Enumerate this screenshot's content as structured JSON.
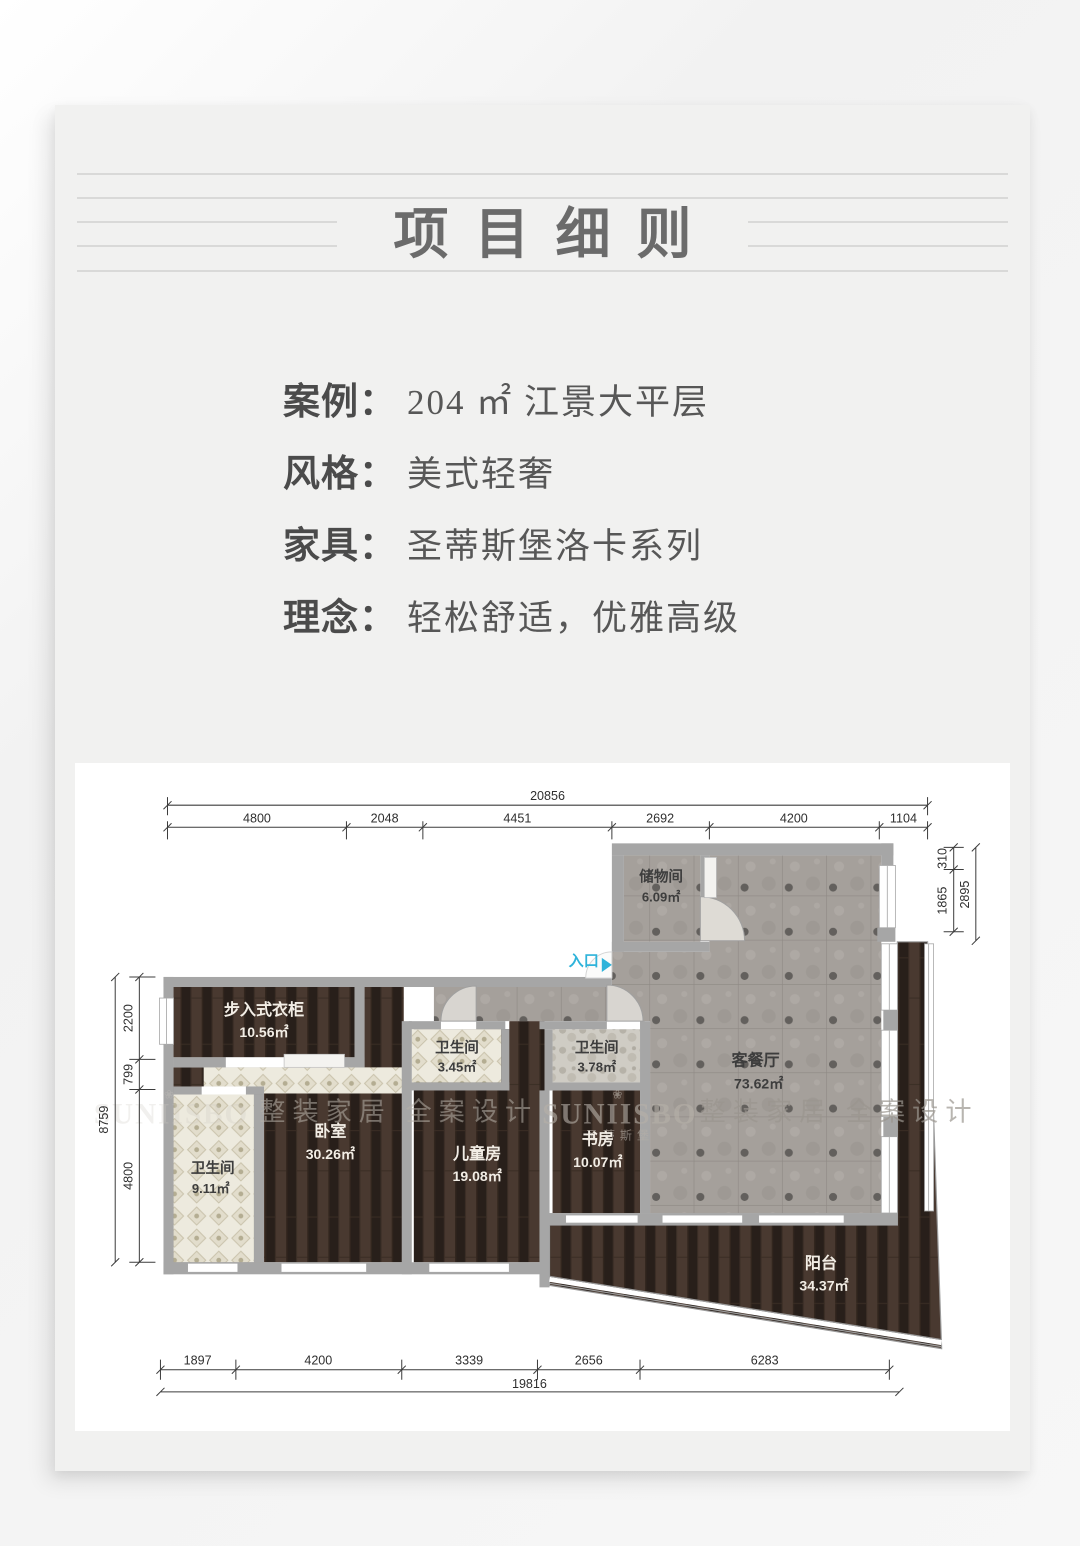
{
  "title": "项目细则",
  "details": [
    {
      "label": "案例：",
      "value": "204 ㎡ 江景大平层"
    },
    {
      "label": "风格：",
      "value": "美式轻奢"
    },
    {
      "label": "家具：",
      "value": "圣蒂斯堡洛卡系列"
    },
    {
      "label": "理念：",
      "value": "轻松舒适，优雅高级"
    }
  ],
  "colors": {
    "entrance_accent": "#2fb3da",
    "wall": "#a6a6a6",
    "wood_floor": "#493930",
    "tile_floor": "#a5a09b",
    "bath_tile": "#edeade",
    "panel_bg": "#f1f1f0"
  },
  "floorplan": {
    "entrance_label": "入口",
    "watermark": {
      "brand": "SUNIISBO",
      "brand_cn": "圣蒂斯堡",
      "flower_icon": "❀",
      "slogan": "整装家居 全案设计"
    },
    "rooms": [
      {
        "name": "储物间",
        "area": "6.09㎡"
      },
      {
        "name": "客餐厅",
        "area": "73.62㎡"
      },
      {
        "name": "步入式衣柜",
        "area": "10.56㎡"
      },
      {
        "name": "卫生间",
        "area": "3.45㎡"
      },
      {
        "name": "卫生间",
        "area": "3.78㎡"
      },
      {
        "name": "卧室",
        "area": "30.26㎡"
      },
      {
        "name": "儿童房",
        "area": "19.08㎡"
      },
      {
        "name": "书房",
        "area": "10.07㎡"
      },
      {
        "name": "卫生间",
        "area": "9.11㎡"
      },
      {
        "name": "阳台",
        "area": "34.37㎡"
      }
    ],
    "dims": {
      "top_total": "20856",
      "top_segments": [
        "4800",
        "2048",
        "4451",
        "2692",
        "4200",
        "1104"
      ],
      "right_segments": [
        "310",
        "1865",
        "2895"
      ],
      "left_total": "8759",
      "left_segments": [
        "2200",
        "799",
        "4800"
      ],
      "bottom_segments": [
        "1897",
        "4200",
        "3339",
        "2656",
        "6283"
      ],
      "bottom_total": "19816"
    }
  }
}
